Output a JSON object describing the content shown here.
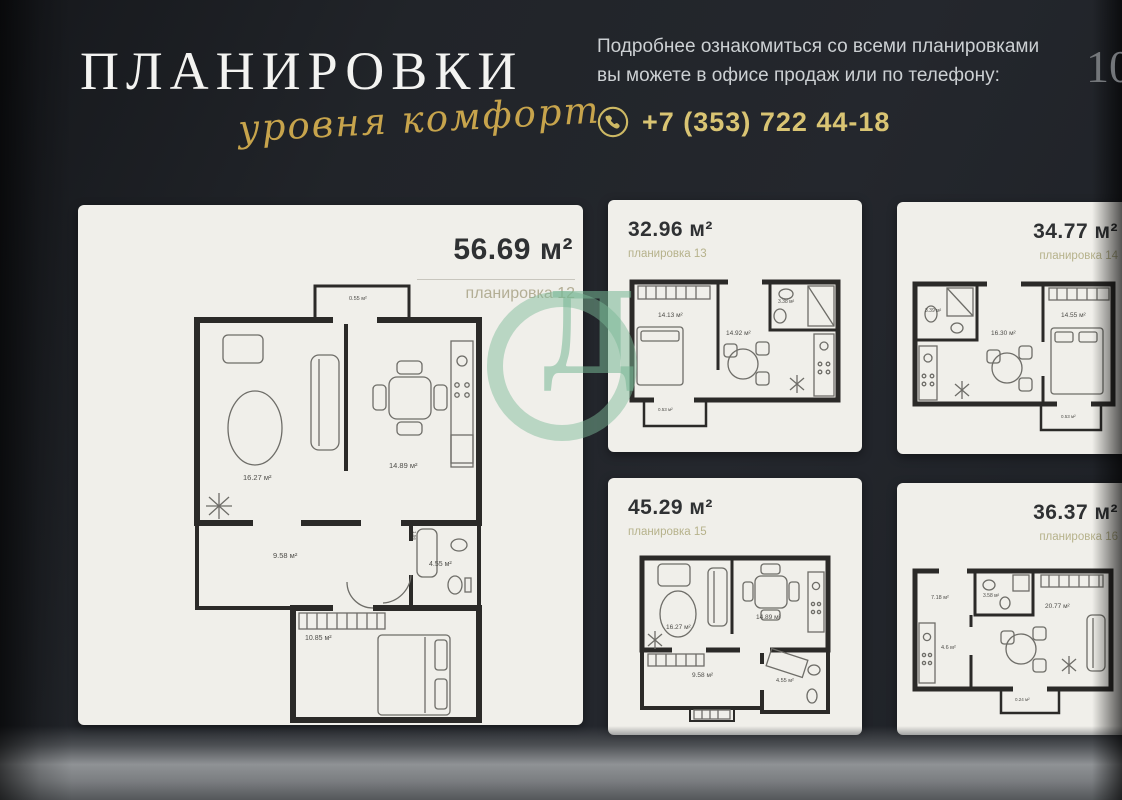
{
  "header": {
    "title": "ПЛАНИРОВКИ",
    "script_subtitle": "уровня комфорт",
    "info_line1": "Подробнее ознакомиться со всеми планировками",
    "info_line2": "вы можете в офисе продаж или по телефону:",
    "phone": "+7 (353) 722 44-18",
    "page_number": "10"
  },
  "watermark": {
    "letter": "Д",
    "color": "#79b694"
  },
  "plans": {
    "main": {
      "area": "56.69 м²",
      "name": "планировка 12",
      "rooms": {
        "balcony": "0.55 м²",
        "living": "16.27 м²",
        "kitchen": "14.89 м²",
        "hall": "9.58 м²",
        "bath": "4.55 м²",
        "duct": "1.56",
        "bedroom": "10.85 м²"
      }
    },
    "p13": {
      "area": "32.96 м²",
      "name": "планировка 13",
      "rooms": {
        "bedroom": "14.13 м²",
        "kitchen": "14.92 м²",
        "bath": "3.38 м²",
        "balcony": "0.53 м²"
      }
    },
    "p14": {
      "area": "34.77 м²",
      "name": "планировка 14",
      "rooms": {
        "bath": "3.39 м²",
        "kitchen": "16.30 м²",
        "bedroom": "14.55 м²",
        "balcony": "0.53 м²"
      }
    },
    "p15": {
      "area": "45.29 м²",
      "name": "планировка 15",
      "rooms": {
        "living": "16.27 м²",
        "kitchen": "14.89 м²",
        "hall": "9.58 м²",
        "bath": "4.55 м²"
      }
    },
    "p16": {
      "area": "36.37 м²",
      "name": "планировка 16",
      "rooms": {
        "hall": "7.18 м²",
        "bath": "3.58 м²",
        "living": "20.77 м²",
        "kitchen": "4.6 м²",
        "balcony": "0.24 м²"
      }
    }
  },
  "colors": {
    "background": "#22252b",
    "paper": "#f0efea",
    "gold": "#d9c473",
    "walls": "#2b2a28"
  }
}
